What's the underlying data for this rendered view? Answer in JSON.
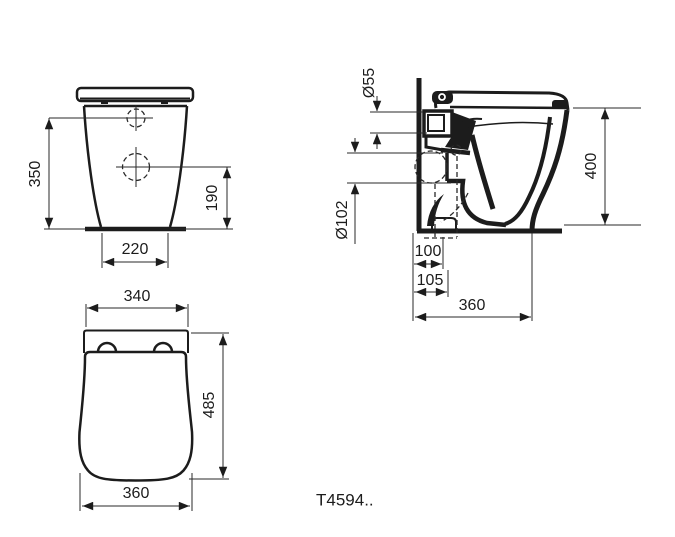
{
  "drawing": {
    "model": "T4594..",
    "type": "sanitary-ware-technical-drawing",
    "line_color": "#1c1c1c",
    "background": "#ffffff",
    "views": {
      "front": {
        "name": "front-elevation",
        "dims": {
          "height_to_hole": "350",
          "lower_hole_height": "190",
          "base_width": "220"
        }
      },
      "side": {
        "name": "side-section",
        "dims": {
          "inlet_diameter": "Ø55",
          "outlet_diameter": "Ø102",
          "outlet_offset_min": "100",
          "outlet_offset_max": "105",
          "depth": "360",
          "height": "400"
        }
      },
      "top": {
        "name": "plan-view",
        "dims": {
          "back_width": "340",
          "length": "485",
          "front_width": "360"
        }
      }
    }
  }
}
